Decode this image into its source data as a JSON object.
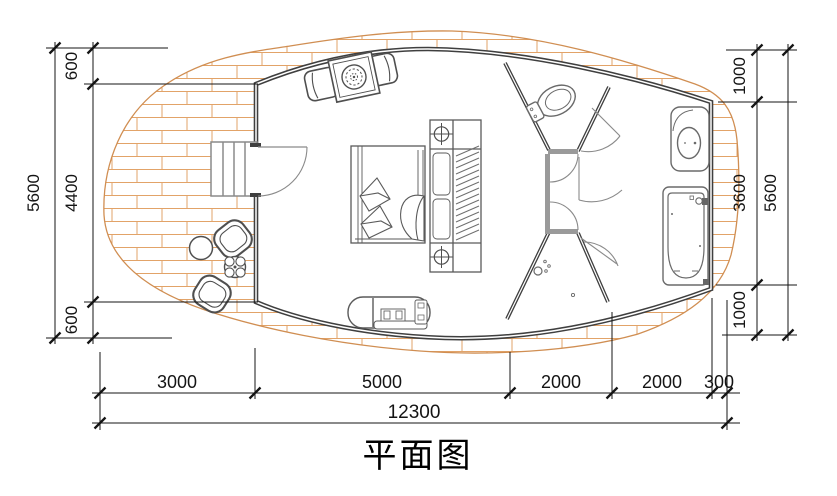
{
  "title": {
    "text": "平面图"
  },
  "dimensions": {
    "left_outer": {
      "total": "5600"
    },
    "left_inner": {
      "segments": [
        "600",
        "4400",
        "600"
      ]
    },
    "right_outer": {
      "total": "5600"
    },
    "right_inner": {
      "segments": [
        "1000",
        "3600",
        "1000"
      ]
    },
    "bottom_segments": {
      "segments": [
        "3000",
        "5000",
        "2000",
        "2000",
        "300"
      ]
    },
    "bottom_total": {
      "total": "12300"
    }
  },
  "colors": {
    "deck_brick": "#e2a368",
    "deck_edge": "#d08e52",
    "wall": "#3f3f3f",
    "partition_gray": "#9a9a9a",
    "furniture": "#4f4f4f",
    "dimension": "#141414",
    "background": "#ffffff"
  },
  "fixtures": [
    "wood-deck",
    "entry-stairs",
    "entry-door",
    "outdoor-armchairs",
    "outdoor-round-table",
    "planter",
    "lounge-chairs",
    "grill-table",
    "double-bed",
    "pillows",
    "blanket",
    "bedside-cabinet",
    "reading-lamps",
    "wardrobe-rail",
    "chaise-lounge",
    "toilet-room",
    "toilet",
    "corridor-doors",
    "shower-room",
    "shower-head",
    "sink-vanity",
    "bathtub"
  ]
}
